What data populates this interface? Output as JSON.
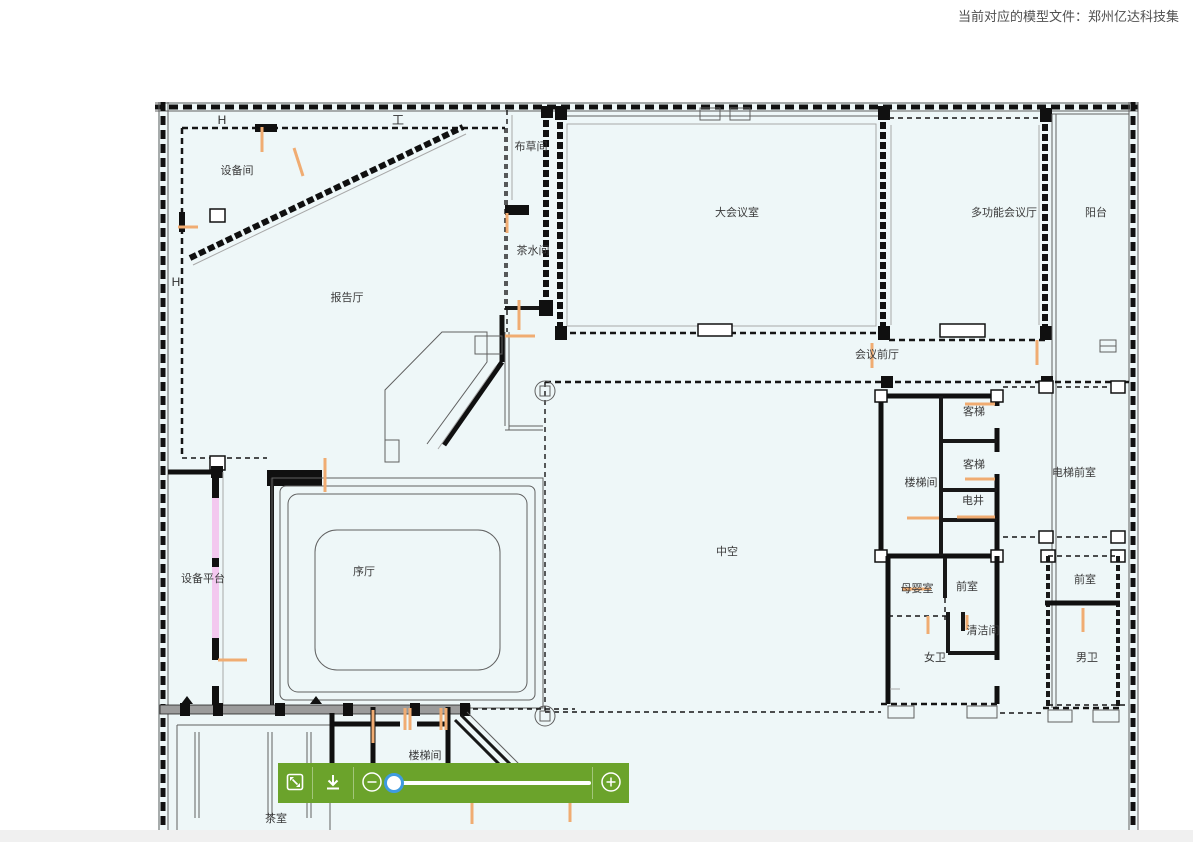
{
  "header": {
    "model_file_text": "当前对应的模型文件：郑州亿达科技集"
  },
  "plan": {
    "markers": [
      {
        "label": "H"
      },
      {
        "label": "工"
      },
      {
        "label": "H"
      }
    ],
    "rooms": [
      {
        "label": "设备间"
      },
      {
        "label": "报告厅"
      },
      {
        "label": "布草间"
      },
      {
        "label": "茶水间"
      },
      {
        "label": "大会议室"
      },
      {
        "label": "多功能会议厅"
      },
      {
        "label": "阳台"
      },
      {
        "label": "会议前厅"
      },
      {
        "label": "客梯"
      },
      {
        "label": "客梯"
      },
      {
        "label": "楼梯间"
      },
      {
        "label": "电井"
      },
      {
        "label": "电梯前室"
      },
      {
        "label": "中空"
      },
      {
        "label": "设备平台"
      },
      {
        "label": "序厅"
      },
      {
        "label": "母婴室"
      },
      {
        "label": "前室"
      },
      {
        "label": "清洁间"
      },
      {
        "label": "女卫"
      },
      {
        "label": "前室"
      },
      {
        "label": "男卫"
      },
      {
        "label": "楼梯间"
      },
      {
        "label": "茶室"
      }
    ],
    "colors": {
      "background": "#eef7f8",
      "wall": "#101010",
      "accent_orange": "#f0ac72",
      "accent_pink": "#f3c8ef"
    }
  },
  "toolbar": {
    "background": "#6ba32b",
    "icons": [
      {
        "name": "fit-screen-icon"
      },
      {
        "name": "download-icon"
      },
      {
        "name": "zoom-out-icon"
      },
      {
        "name": "zoom-in-icon"
      }
    ],
    "slider": {
      "value_percent": 1,
      "handle_color": "#3f9be0"
    }
  },
  "footer": {
    "color": "#f0f0f0"
  }
}
